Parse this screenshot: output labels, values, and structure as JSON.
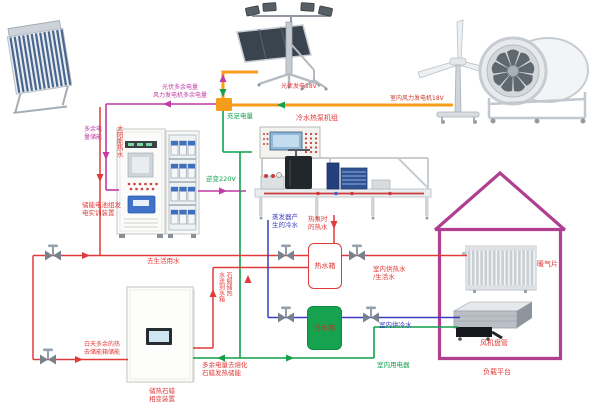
{
  "colors": {
    "pipe_hot_red": "#e03a3a",
    "pipe_cold_blue": "#3c3cc0",
    "wire_green": "#11a04c",
    "wire_magenta": "#c13aa6",
    "wire_orange": "#f59c1a",
    "house_outline": "#b03f90",
    "cold_tank_fill": "#16a24f"
  },
  "labels": {
    "pv_wind_surplus": "光伏多余电量\n风力发电机多余电量",
    "pv_generation_18v": "光伏发电18V",
    "indoor_wind_18v": "室内风力发电机18V",
    "sufficient_power": "充足电量",
    "surplus_to_storage": "多余电\n量储能",
    "battery_trainer": "储能电池组发\n电实训装置",
    "inverter_220v": "逆变220V",
    "heat_pump_unit": "冷水热泵机组",
    "evaporator_cold_water": "蒸发器产\n生的冷水",
    "heat_pump_hot_water": "热泵时\n的热水",
    "hot_water_tank": "热水箱",
    "cold_water_tank": "冷水箱",
    "to_domestic_water": "去生活用水",
    "solar_hot_water": "太阳能热水",
    "indoor_hot_supply": "室内供热水\n/生活水",
    "indoor_cold_supply": "室内供冷水",
    "radiator": "暖气片",
    "fan_coil": "风机盘管",
    "load_platform": "负载平台",
    "indoor_appliances": "室内用电器",
    "day_surplus_heat": "白天多余的热\n去储能箱储能",
    "paraffin_device": "储热石蜡\n相变装置",
    "surplus_melt_paraffin": "多余电量去熔化\n石蜡发热储能",
    "paraffin_heat_to_tank": "石蜡储热\n水送到水箱"
  }
}
